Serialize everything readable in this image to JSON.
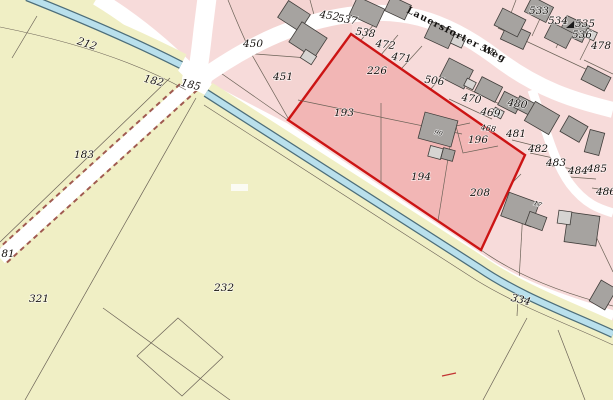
{
  "map": {
    "kind": "cadastral-parcel-map",
    "street": {
      "name": "Lauersforter Weg",
      "street_parcel_label": "558"
    },
    "highlighted_parcels": [
      "226",
      "193",
      "194",
      "196",
      "208"
    ],
    "house_number_labels": [
      "90",
      "17"
    ],
    "colors": {
      "field": "#f0efc5",
      "residential": "#f7dbda",
      "residential_dark": "#f3cdcc",
      "highlight_fill": "#f2b6b5",
      "highlight_border": "#cc1414",
      "road": "#ffffff",
      "road_dash": "#a05a50",
      "stream_fill": "#b9e0ec",
      "stream_edge": "#4d6e7a",
      "parcel_line": "#6b6257",
      "building": "#a6a3a0",
      "building_light": "#d6d4d2",
      "building_stroke": "#403d3a",
      "label": "#171310"
    },
    "street_label": {
      "text": "Lauersforter Weg",
      "x": 406,
      "y": 12,
      "rot": 27,
      "size": 9.5
    },
    "labels": [
      {
        "t": "450",
        "x": 253,
        "y": 47
      },
      {
        "t": "451",
        "x": 283,
        "y": 80
      },
      {
        "t": "452",
        "x": 329,
        "y": 19,
        "r": 8
      },
      {
        "t": "537",
        "x": 347,
        "y": 23,
        "r": 8
      },
      {
        "t": "538",
        "x": 365,
        "y": 36,
        "r": 8
      },
      {
        "t": "472",
        "x": 385,
        "y": 48,
        "r": 8
      },
      {
        "t": "471",
        "x": 401,
        "y": 61,
        "r": 8
      },
      {
        "t": "506",
        "x": 434,
        "y": 84,
        "r": 8
      },
      {
        "t": "226",
        "x": 377,
        "y": 74
      },
      {
        "t": "193",
        "x": 344,
        "y": 116
      },
      {
        "t": "194",
        "x": 421,
        "y": 180
      },
      {
        "t": "196",
        "x": 478,
        "y": 143
      },
      {
        "t": "208",
        "x": 480,
        "y": 196
      },
      {
        "t": "470",
        "x": 471,
        "y": 102,
        "r": 8
      },
      {
        "t": "469",
        "x": 490,
        "y": 116,
        "r": 8
      },
      {
        "t": "468",
        "x": 488,
        "y": 131,
        "r": 8,
        "s": 8
      },
      {
        "t": "480",
        "x": 517,
        "y": 107,
        "r": 8
      },
      {
        "t": "481",
        "x": 516,
        "y": 137
      },
      {
        "t": "482",
        "x": 538,
        "y": 152
      },
      {
        "t": "483",
        "x": 556,
        "y": 166
      },
      {
        "t": "484",
        "x": 578,
        "y": 174
      },
      {
        "t": "485",
        "x": 597,
        "y": 172
      },
      {
        "t": "486",
        "x": 606,
        "y": 195
      },
      {
        "t": "478",
        "x": 601,
        "y": 49
      },
      {
        "t": "533",
        "x": 539,
        "y": 14
      },
      {
        "t": "534",
        "x": 558,
        "y": 24
      },
      {
        "t": "535",
        "x": 585,
        "y": 27
      },
      {
        "t": "536",
        "x": 582,
        "y": 38
      },
      {
        "t": "558",
        "x": 487,
        "y": 53,
        "r": 25,
        "s": 8.5
      },
      {
        "t": "212",
        "x": 86,
        "y": 47,
        "r": 18
      },
      {
        "t": "182",
        "x": 153,
        "y": 84,
        "r": 14
      },
      {
        "t": "185",
        "x": 190,
        "y": 88,
        "r": 14
      },
      {
        "t": "183",
        "x": 84,
        "y": 158
      },
      {
        "t": "81",
        "x": 8,
        "y": 257
      },
      {
        "t": "321",
        "x": 39,
        "y": 302
      },
      {
        "t": "232",
        "x": 224,
        "y": 291
      },
      {
        "t": "334",
        "x": 520,
        "y": 303,
        "r": 14
      },
      {
        "t": "90",
        "x": 438,
        "y": 135,
        "s": 6.5,
        "r": 15
      },
      {
        "t": "17",
        "x": 537,
        "y": 206,
        "s": 6.5,
        "r": 20
      }
    ]
  }
}
